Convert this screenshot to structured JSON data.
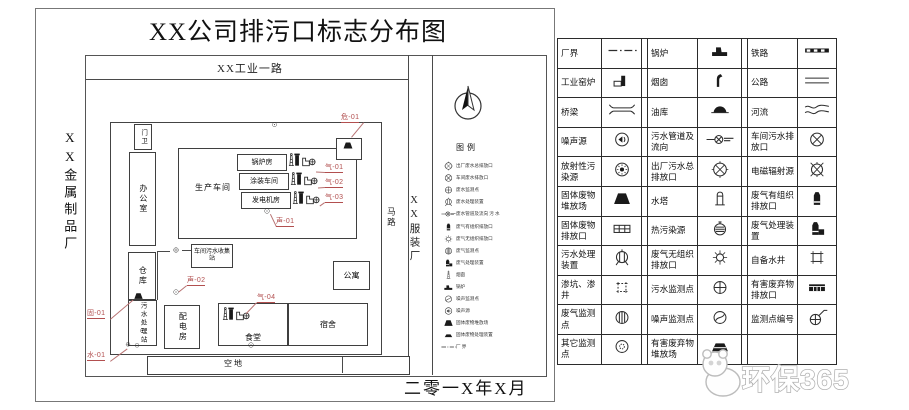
{
  "title": "XX公司排污口标志分布图",
  "date": "二零一X年X月",
  "top_road": "XX工业一路",
  "road_right": "马路",
  "left_factory": "XX金属制品厂",
  "right_factory": "XX服装厂",
  "watermark": "环保365",
  "colors": {
    "accent_red": "#b24f4f",
    "line": "#3a3a3a"
  },
  "map_legend": {
    "title": "图例",
    "items": [
      {
        "i": "circle-x-main",
        "t": "出厂废水总排放口"
      },
      {
        "i": "circle-x",
        "t": "车间废水排放口"
      },
      {
        "i": "water-monitor",
        "t": "废水监测点"
      },
      {
        "i": "sewage-treatment",
        "t": "废水处理装置"
      },
      {
        "i": "sewer-pipe-flow",
        "t": "废水管道及流向  污 水"
      },
      {
        "i": "gas-stack",
        "t": "废气有组织排放口"
      },
      {
        "i": "sun",
        "t": "废气无组织排放口"
      },
      {
        "i": "gas-monitor",
        "t": "废气监测点"
      },
      {
        "i": "gas-treatment",
        "t": "废气处理装置"
      },
      {
        "i": "chimney-tower",
        "t": "烟囱"
      },
      {
        "i": "boiler",
        "t": "锅炉"
      },
      {
        "i": "noise-monitor",
        "t": "噪声监测点"
      },
      {
        "i": "noise-source",
        "t": "噪声源"
      },
      {
        "i": "solid-waste",
        "t": "固体废物堆放场"
      },
      {
        "i": "solid-waste-flat",
        "t": "固体废物处理装置"
      },
      {
        "i": "boundary-line",
        "t": "厂  界"
      }
    ]
  },
  "buildings": [
    {
      "n": "gatehouse",
      "t": "门卫",
      "x": 134,
      "y": 124,
      "w": 16,
      "h": 24,
      "v": 1,
      "fs": 6.5
    },
    {
      "n": "office",
      "t": "办公室",
      "x": 129,
      "y": 152,
      "w": 25,
      "h": 92,
      "v": 1,
      "fs": 8
    },
    {
      "n": "workshop",
      "t": "生产车间",
      "x": 178,
      "y": 148,
      "w": 177,
      "h": 89,
      "lp": "ws",
      "fs": 8
    },
    {
      "n": "boiler-room",
      "t": "锅炉房",
      "x": 237,
      "y": 154,
      "w": 48,
      "h": 15,
      "fs": 7
    },
    {
      "n": "paint-shop",
      "t": "涂装车间",
      "x": 239,
      "y": 173,
      "w": 48,
      "h": 15,
      "fs": 7
    },
    {
      "n": "generator-room",
      "t": "发电机房",
      "x": 241,
      "y": 192,
      "w": 48,
      "h": 15,
      "fs": 7
    },
    {
      "n": "hazwaste-shed",
      "t": "",
      "x": 336,
      "y": 138,
      "w": 24,
      "h": 20
    },
    {
      "n": "collection-station",
      "t": "车间污水收集站",
      "x": 191,
      "y": 244,
      "w": 40,
      "h": 22,
      "fs": 6
    },
    {
      "n": "warehouse",
      "t": "仓库",
      "x": 128,
      "y": 252,
      "w": 26,
      "h": 46,
      "v": 1,
      "fs": 8
    },
    {
      "n": "sewage-station",
      "t": "污水处理站",
      "x": 128,
      "y": 300,
      "w": 27,
      "h": 44,
      "v": 1,
      "fs": 6.5
    },
    {
      "n": "power-room",
      "t": "配电房",
      "x": 164,
      "y": 305,
      "w": 34,
      "h": 42,
      "v": 1,
      "fs": 8
    },
    {
      "n": "canteen",
      "t": "食堂",
      "x": 218,
      "y": 303,
      "w": 68,
      "h": 41,
      "lp": "b",
      "fs": 8
    },
    {
      "n": "dorm",
      "t": "宿舍",
      "x": 288,
      "y": 303,
      "w": 78,
      "h": 41,
      "fs": 8
    },
    {
      "n": "apartment",
      "t": "公寓",
      "x": 333,
      "y": 261,
      "w": 35,
      "h": 27,
      "fs": 8
    },
    {
      "n": "empty-lot",
      "t": "空地",
      "x": 147,
      "y": 356,
      "w": 261,
      "h": 17,
      "lp": "el",
      "fs": 8
    }
  ],
  "outlet_labels": [
    {
      "t": "危-01",
      "x": 341,
      "y": 114,
      "tx": 352,
      "ty": 137
    },
    {
      "t": "气-01",
      "x": 325,
      "y": 164,
      "tx": 316,
      "ty": 172
    },
    {
      "t": "气-02",
      "x": 325,
      "y": 179,
      "tx": 318,
      "ty": 188
    },
    {
      "t": "气-03",
      "x": 325,
      "y": 194,
      "tx": 320,
      "ty": 206
    },
    {
      "t": "声-01",
      "x": 276,
      "y": 218,
      "tx": 270,
      "ty": 214
    },
    {
      "t": "声-02",
      "x": 187,
      "y": 277,
      "tx": 179,
      "ty": 292
    },
    {
      "t": "气-04",
      "x": 257,
      "y": 294,
      "tx": 247,
      "ty": 313
    },
    {
      "t": "固-01",
      "x": 87,
      "y": 310,
      "tx": 133,
      "ty": 299
    },
    {
      "t": "水-01",
      "x": 87,
      "y": 352,
      "tx": 127,
      "ty": 348
    }
  ],
  "markers": [
    {
      "i": "stack-group",
      "x": 286,
      "y": 149,
      "w": 30
    },
    {
      "i": "stack-group",
      "x": 288,
      "y": 168,
      "w": 30
    },
    {
      "i": "stack-group",
      "x": 290,
      "y": 187,
      "w": 30
    },
    {
      "i": "stack-group",
      "x": 220,
      "y": 303,
      "w": 30
    },
    {
      "i": "solid-waste",
      "x": 340,
      "y": 140,
      "w": 16
    },
    {
      "i": "solid-waste",
      "x": 131,
      "y": 291,
      "w": 15
    },
    {
      "i": "circle-dot",
      "x": 269,
      "y": 121,
      "w": 11
    },
    {
      "i": "circle-dot",
      "x": 261,
      "y": 207,
      "w": 12
    },
    {
      "i": "circle-dot",
      "x": 170,
      "y": 288,
      "w": 12
    },
    {
      "i": "circle-dot",
      "x": 245,
      "y": 341,
      "w": 12
    },
    {
      "i": "circle-dot",
      "x": 137,
      "y": 327,
      "w": 11
    },
    {
      "i": "circle-plus",
      "x": 123,
      "y": 341,
      "w": 10
    },
    {
      "i": "circle-dot",
      "x": 132,
      "y": 342,
      "w": 10
    },
    {
      "i": "circle-plus",
      "x": 170,
      "y": 246,
      "w": 12
    },
    {
      "i": "hline",
      "x": 182,
      "y": 250,
      "w": 9
    },
    {
      "i": "hline",
      "x": 157,
      "y": 251,
      "w": 13
    },
    {
      "i": "vline",
      "x": 157,
      "y": 251,
      "h": 49
    },
    {
      "i": "vline",
      "x": 342,
      "y": 357,
      "h": 16
    }
  ],
  "legend_table": {
    "rows": [
      [
        {
          "t": "厂界",
          "i": "boundary-line"
        },
        {
          "t": "锅炉",
          "i": "boiler"
        },
        {
          "t": "铁路",
          "i": "railway"
        }
      ],
      [
        {
          "t": "工业窑炉",
          "i": "kiln"
        },
        {
          "t": "烟囱",
          "i": "chimney-curved"
        },
        {
          "t": "公路",
          "i": "road"
        }
      ],
      [
        {
          "t": "桥梁",
          "i": "bridge"
        },
        {
          "t": "油库",
          "i": "oil-depot"
        },
        {
          "t": "河流",
          "i": "river"
        }
      ],
      [
        {
          "t": "噪声源",
          "i": "noise-source"
        },
        {
          "t": "污水管道及流向",
          "i": "sewer-pipe-flow"
        },
        {
          "t": "车间污水排放口",
          "i": "circle-x"
        }
      ],
      [
        {
          "t": "放射性污染源",
          "i": "radioactive"
        },
        {
          "t": "出厂污水总排放口",
          "i": "circle-x-main"
        },
        {
          "t": "电磁辐射源",
          "i": "em-radiation"
        }
      ],
      [
        {
          "t": "固体废物堆放场",
          "i": "solid-waste"
        },
        {
          "t": "水塔",
          "i": "water-tower"
        },
        {
          "t": "废气有组织排放口",
          "i": "gas-stack"
        }
      ],
      [
        {
          "t": "固体废物排放口",
          "i": "solid-waste-outlet"
        },
        {
          "t": "热污染源",
          "i": "thermal"
        },
        {
          "t": "废气处理装置",
          "i": "gas-treatment"
        }
      ],
      [
        {
          "t": "污水处理装置",
          "i": "sewage-treatment"
        },
        {
          "t": "废气无组织排放口",
          "i": "sun"
        },
        {
          "t": "自备水井",
          "i": "well"
        }
      ],
      [
        {
          "t": "渗坑、渗井",
          "i": "seep-pit"
        },
        {
          "t": "污水监测点",
          "i": "water-monitor"
        },
        {
          "t": "有害废弃物排放口",
          "i": "hazwaste-outlet"
        }
      ],
      [
        {
          "t": "废气监测点",
          "i": "gas-monitor"
        },
        {
          "t": "噪声监测点",
          "i": "noise-monitor"
        },
        {
          "t": "监测点编号",
          "i": "monitor-id"
        }
      ],
      [
        {
          "t": "其它监测点",
          "i": "other-monitor"
        },
        {
          "t": "有害废弃物堆放场",
          "i": "hazwaste-site"
        },
        null
      ]
    ]
  }
}
